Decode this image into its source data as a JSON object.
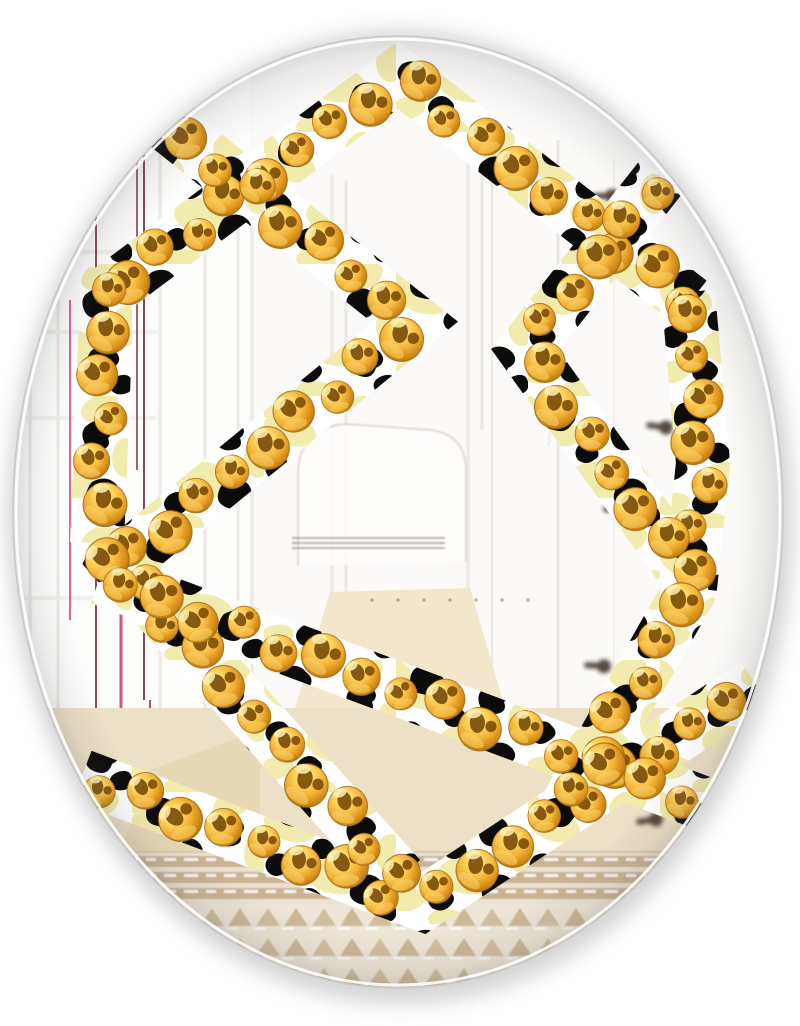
{
  "image": {
    "title": "Oval Wall Mirror Product Photo",
    "description": "Frameless oval wall mirror with a hexagon-star overlay printed in a black, white and pale-yellow leopard pattern decorated with glossy gold pearls; the glass reflects a bright white hallway with paneled doors, a dark-hinged white door, light wood floor and a tan woven runner rug.",
    "width": 800,
    "height": 1026,
    "background": "#ffffff"
  },
  "mirror": {
    "cx": 398,
    "cy": 512,
    "rx": 385,
    "ry": 476,
    "glass": "#fdfdfc",
    "rim_outer": "#c9c9c9",
    "rim_inner": "#ffffff",
    "shadow_color": "#b5b5b5",
    "shadow_color_soft": "#c8c8c8",
    "vignette": "#5a5a5a"
  },
  "overlay": {
    "band_width": 54,
    "leopard": {
      "background": "#ffffff",
      "spot_black": "#0b0b0b",
      "patch_yellow": "#f1ebad"
    },
    "pearls": {
      "radius": 20,
      "spacing": 43,
      "gold_light": "#fff2b8",
      "gold_mid": "#ffd968",
      "gold": "#f2b237",
      "gold_dark": "#d18a16",
      "gold_deep": "#aa6d0c",
      "spot": "#7c4d06",
      "glint": "#fff0b0",
      "crescent": "#fbd469",
      "rim": "#9a6410"
    },
    "band_paths": [
      {
        "name": "top-chevron",
        "points": [
          [
            108,
            292
          ],
          [
            398,
            75
          ],
          [
            690,
            302
          ]
        ]
      },
      {
        "name": "left-bar",
        "points": [
          [
            108,
            268
          ],
          [
            97,
            543
          ]
        ]
      },
      {
        "name": "right-bar",
        "points": [
          [
            688,
            292
          ],
          [
            703,
            463
          ],
          [
            690,
            588
          ]
        ]
      },
      {
        "name": "left-side-chevron",
        "points": [
          [
            168,
            126
          ],
          [
            415,
            322
          ],
          [
            100,
            580
          ]
        ]
      },
      {
        "name": "right-side-chevron",
        "points": [
          [
            665,
            172
          ],
          [
            525,
            350
          ],
          [
            679,
            564
          ]
        ]
      },
      {
        "name": "bottom-chevron",
        "points": [
          [
            82,
            776
          ],
          [
            422,
            904
          ],
          [
            756,
            684
          ]
        ]
      },
      {
        "name": "lower-left-diagonal",
        "points": [
          [
            97,
            540
          ],
          [
            400,
            878
          ]
        ]
      },
      {
        "name": "lower-right-diagonal",
        "points": [
          [
            692,
            586
          ],
          [
            565,
            810
          ]
        ]
      },
      {
        "name": "lower-cross-diagonal",
        "points": [
          [
            100,
            578
          ],
          [
            735,
            815
          ]
        ]
      }
    ]
  },
  "reflection": {
    "wall": "#fbfaf9",
    "wall_bright": "#fefefd",
    "frame_line": "#e8e6e2",
    "frame_line_soft": "#f0eeea",
    "panel_lines": [
      {
        "x": 30,
        "y1": 140,
        "y2": 900
      },
      {
        "x": 58,
        "y1": 120,
        "y2": 940
      },
      {
        "x": 160,
        "y1": 150,
        "y2": 930
      },
      {
        "x": 205,
        "y1": 170,
        "y2": 900
      },
      {
        "x": 238,
        "y1": 165,
        "y2": 880
      },
      {
        "x": 252,
        "y1": 170,
        "y2": 868
      },
      {
        "x": 332,
        "y1": 175,
        "y2": 598
      },
      {
        "x": 346,
        "y1": 180,
        "y2": 598
      },
      {
        "x": 468,
        "y1": 150,
        "y2": 600
      },
      {
        "x": 482,
        "y1": 155,
        "y2": 430
      }
    ],
    "mullion_lines": [
      {
        "y": 252,
        "x1": 18,
        "x2": 158
      },
      {
        "y": 332,
        "x1": 18,
        "x2": 158
      },
      {
        "y": 418,
        "x1": 20,
        "x2": 156
      },
      {
        "y": 598,
        "x1": 24,
        "x2": 152
      }
    ],
    "accent_lines": [
      {
        "x": 70,
        "y1": 300,
        "y2": 620,
        "color": "#d44a86",
        "w": 2
      },
      {
        "x": 96,
        "y1": 210,
        "y2": 900,
        "color": "#7c2c45",
        "w": 2
      },
      {
        "x": 121,
        "y1": 250,
        "y2": 880,
        "color": "#c13a72",
        "w": 3
      },
      {
        "x": 137,
        "y1": 160,
        "y2": 470,
        "color": "#8a4a5e",
        "w": 2
      },
      {
        "x": 144,
        "y1": 150,
        "y2": 700,
        "color": "#6f2840",
        "w": 2
      },
      {
        "x": 150,
        "y1": 700,
        "y2": 930,
        "color": "#9c3258",
        "w": 2
      }
    ],
    "door": {
      "x": 488,
      "y": 140,
      "w": 300,
      "h": 575,
      "fill": "#fbfaf8",
      "gap_x": 558,
      "edge_x": 492,
      "inner_x": 614
    },
    "hardware_color": "#3a2a24",
    "hardware": [
      {
        "x": 608,
        "y": 196,
        "rot": 0
      },
      {
        "x": 662,
        "y": 427,
        "rot": 8
      },
      {
        "x": 619,
        "y": 508,
        "rot": -5
      },
      {
        "x": 600,
        "y": 666,
        "rot": 4
      },
      {
        "x": 686,
        "y": 794,
        "rot": 10
      },
      {
        "x": 652,
        "y": 820,
        "rot": -8
      }
    ],
    "chair": {
      "outline": "#dcd8d1",
      "fill": "#fefdfc",
      "stripe_color": "#9a9288",
      "stripe_y": [
        538,
        543,
        548
      ],
      "stripe_x1": 292,
      "stripe_x2": 445,
      "dot_color": "#b0623c",
      "dot_y": 600,
      "dot_x1": 372,
      "dot_x2": 528,
      "dot_step": 26
    },
    "ceiling_line": "#dcd9d5",
    "floor": {
      "y": 708,
      "h": 146,
      "color": "#ece0c6",
      "wedge": "#e6d6b2",
      "doorway": "#f2e7cd"
    },
    "rug": {
      "y": 852,
      "mid": 904,
      "bottom": 990,
      "base": "#c9b392",
      "stripe": "#efe8d8",
      "fringe": "#ffffff",
      "tri_base": "#eee7d7",
      "tri": "#cdb795",
      "edge": "#d8c8ac"
    }
  }
}
